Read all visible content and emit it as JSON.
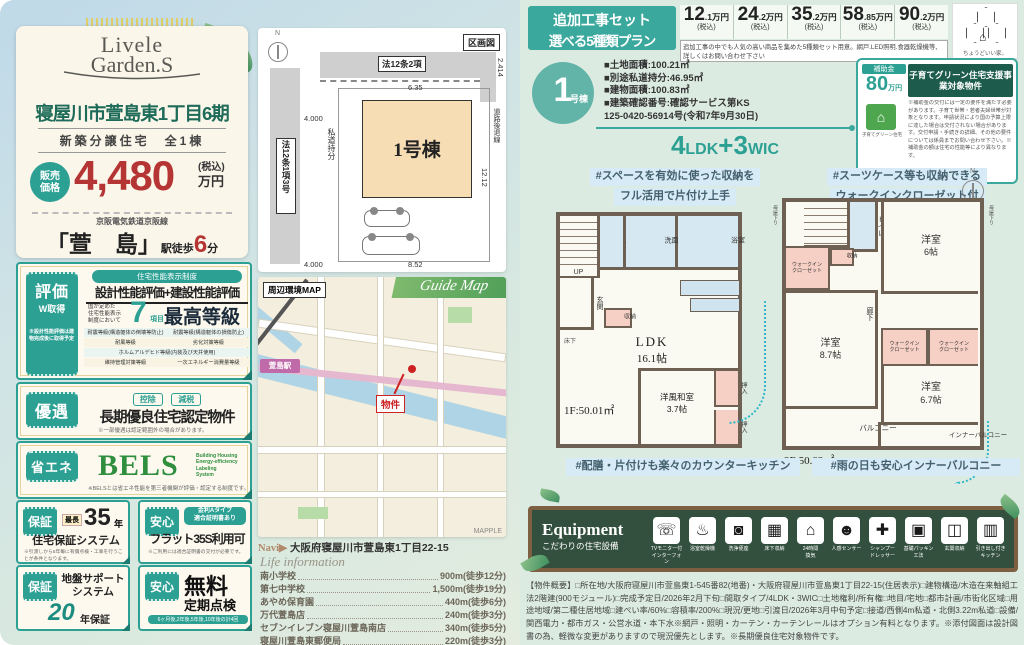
{
  "left": {
    "logo1": "Livele",
    "logo2": "Garden.S",
    "title": "寝屋川市萱島東1丁目6期",
    "subtitle": "新築分譲住宅　全1棟",
    "price": {
      "label1": "販売",
      "label2": "価格",
      "value": "4,480",
      "tax": "(税込)",
      "unit": "万円"
    },
    "rail": "京阪電気鉄道京阪線",
    "station": {
      "name": "「萱　島」",
      "pre": "駅徒歩",
      "min": "6",
      "unit": "分"
    },
    "hyouka": {
      "tab": "評価",
      "tab2": "W取得",
      "tabnote": "※設計性能評価は建物完成後に取得予定",
      "pill": "住宅性能表示制度",
      "line": "設計性能評価+建設性能評価",
      "pre1": "国が定めた",
      "pre2": "住宅性能表示",
      "pre3": "制度において",
      "num": "7",
      "numunit": "項目",
      "grade": "最高等級",
      "items": [
        "耐震等級(構造躯体の倒壊等防止)",
        "耐震等級(構造躯体の損傷防止)",
        "耐風等級",
        "劣化対策等級",
        "ホルムアルデヒド等級(内装及び天井使用)",
        "維持管理対策等級",
        "一次エネルギー消費量等級"
      ]
    },
    "yuuguu": {
      "tab": "優遇",
      "pill1": "控除",
      "pill2": "減税",
      "main": "長期優良住宅認定物件",
      "note": "※一部優遇は認定範囲外の場合があります。"
    },
    "bels": {
      "tab": "省エネ",
      "main": "BELS",
      "sub1": "Building Housing",
      "sub2": "Energy-efficiency",
      "sub3": "Labeling",
      "sub4": "System",
      "note": "※BELSとは省エネ性能を第三者機関が評価・認定する制度です。"
    },
    "hosho35": {
      "tab": "保証",
      "pre": "最長",
      "num": "35",
      "unit": "年",
      "main": "住宅保証システム",
      "note": "※引渡しから5年毎に有償点検・工事を行うことが条件となります。"
    },
    "flat35": {
      "tab": "安心",
      "pill1": "金利Aタイプ",
      "pill2": "適合証明書あり",
      "main": "フラット35S利用可",
      "note": "※ご利用には適合証明書の交付が必要です。"
    },
    "jiban": {
      "tab": "保証",
      "main1": "地盤サポート",
      "main2": "システム",
      "num": "20",
      "unit": "年保証"
    },
    "tenken": {
      "tab": "安心",
      "main1": "無料",
      "main2": "定期点検",
      "note": "6ヶ月後,2年後,5年後,10年後の計4回"
    }
  },
  "site": {
    "label": "区画図",
    "north": "N",
    "road_top": "法12条2項",
    "road_left": "法12条1項3号",
    "shidou": "私道持分",
    "building": "1号棟",
    "setback": "道路後退線",
    "dim_top": "6.35",
    "dim_right_top": "2.414",
    "dim_right": "12.12",
    "dim_bottom": "8.52",
    "dim_left": "4.000",
    "dim_bottom_left": "4.000"
  },
  "map": {
    "label": "周辺環境MAP",
    "banner": "Guide Map",
    "station": "萱島駅",
    "marker": "物件",
    "credit": "MAPPLE",
    "navi_pre": "Navi▶",
    "navi": "大阪府寝屋川市萱島東1丁目22-15"
  },
  "life": {
    "title": "Life information",
    "items": [
      {
        "name": "南小学校",
        "dist": "900m",
        "walk": "(徒歩12分)"
      },
      {
        "name": "第七中学校",
        "dist": "1,500m",
        "walk": "(徒歩19分)"
      },
      {
        "name": "あやめ保育園",
        "dist": "440m",
        "walk": "(徒歩6分)"
      },
      {
        "name": "万代萱島店",
        "dist": "240m",
        "walk": "(徒歩3分)"
      },
      {
        "name": "セブンイレブン寝屋川萱島南店",
        "dist": "340m",
        "walk": "(徒歩5分)"
      },
      {
        "name": "寝屋川萱島東郵便局",
        "dist": "220m",
        "walk": "(徒歩3分)"
      }
    ]
  },
  "right": {
    "plans": {
      "title1": "追加工事セット",
      "title2": "選べる5種類プラン",
      "note": "追加工事の中でも人気の高い商品を集めた5種類セット用意。網戸.LED照明.食器乾燥機等、詳しくはお問い合わせ下さい",
      "items": [
        {
          "main": "12",
          "sub": ".1万円",
          "tax": "(税込)"
        },
        {
          "main": "24",
          "sub": ".2万円",
          "tax": "(税込)"
        },
        {
          "main": "35",
          "sub": ".2万円",
          "tax": "(税込)"
        },
        {
          "main": "58",
          "sub": ".85万円",
          "tax": "(税込)"
        },
        {
          "main": "90",
          "sub": ".2万円",
          "tax": "(税込)"
        }
      ]
    },
    "brand": {
      "tagline": "ちょうどいい家。"
    },
    "bldg": {
      "num": "1",
      "suffix": "号棟",
      "specs": [
        "■土地面積:100.21㎡",
        "■別途私道持分:46.95㎡",
        "■建物面積:100.83㎡",
        "■建築確認番号:確認サービス第KS",
        "125-0420-56914号(令和7年9月30日)"
      ],
      "layout_n1": "4",
      "layout_t1": "LDK",
      "layout_plus": "+",
      "layout_n2": "3",
      "layout_t2": "WIC"
    },
    "subsidy": {
      "label": "補助金",
      "amount": "80",
      "unit": "万円",
      "title": "子育てグリーン住宅支援事業対象物件",
      "house_cap": "子育てグリーン住宅",
      "note": "※補助金の交付には一定の要件を満たす必要があります。子育て世帯・若者夫婦世帯が対象となります。申請状況により国の予算上限に達した場合は交付されない場合があります。交付申請・手続きの詳細、その他の要件については係員までお問い合わせ下さい。※補助金の額は住宅の性能等により異なります。"
    },
    "plan1f": {
      "cap1": "#スペースを有効に使った収納を",
      "cap2": "フル活用で片付け上手",
      "area": "1F:50.01㎡",
      "rooms": {
        "genkan": "玄関",
        "up": "UP",
        "yukashita": "床下",
        "toilet": "トイレ",
        "senmen": "洗面所",
        "bath": "浴室",
        "shuno": "収納",
        "ldk1": "LDK",
        "ldk2": "16.1帖",
        "washitsu1": "洋風和室",
        "washitsu2": "3.7帖",
        "oshiire": "押入"
      },
      "capb": "#配膳・片付けも楽々のカウンターキッチン"
    },
    "plan2f": {
      "cap1": "#スーツケース等も収納できる",
      "cap2": "ウォークインクローゼット付",
      "area": "2F:50.82㎡",
      "rooms": {
        "toilet": "トイレ",
        "y6_1": "洋室",
        "y6_2": "6帖",
        "wic1": "ウォークイン",
        "wic2": "クローゼット",
        "shuno": "収納",
        "rouka": "廊下",
        "y87_1": "洋室",
        "y87_2": "8.7帖",
        "y67_1": "洋室",
        "y67_2": "6.7帖",
        "balcony": "バルコニー",
        "inner": "インナーバルコニー",
        "moya": "母屋下り"
      },
      "capb": "#雨の日も安心インナーバルコニー"
    },
    "equipment": {
      "title": "Equipment",
      "subtitle": "こだわりの住宅設備",
      "items": [
        {
          "glyph": "☏",
          "l1": "TVモニター付",
          "l2": "インターフォン"
        },
        {
          "glyph": "♨",
          "l1": "浴室乾燥機",
          "l2": ""
        },
        {
          "glyph": "◙",
          "l1": "洗浄便座",
          "l2": ""
        },
        {
          "glyph": "▦",
          "l1": "床下収納",
          "l2": ""
        },
        {
          "glyph": "⌂",
          "l1": "24時間",
          "l2": "換気"
        },
        {
          "glyph": "☻",
          "l1": "人感センサー",
          "l2": ""
        },
        {
          "glyph": "✚",
          "l1": "シャンプー",
          "l2": "ドレッサー"
        },
        {
          "glyph": "▣",
          "l1": "基礎パッキン",
          "l2": "工法"
        },
        {
          "glyph": "◫",
          "l1": "玄関収納",
          "l2": ""
        },
        {
          "glyph": "▥",
          "l1": "引き出し付き",
          "l2": "キッチン"
        }
      ]
    },
    "overview": "【物件概要】□所在地/大阪府寝屋川市萱島東1-545番82(地番)・大阪府寝屋川市萱島東1丁目22-15(住居表示)□建物構造/木造在来軸組工法2階建(900モジュール)□完成予定日/2026年2月下旬□間取タイプ/4LDK・3WIC□土地権利/所有権□地目/宅地□都市計画/市街化区域□用途地域/第二種住居地域□建ぺい率/60%□容積率/200%□現況/更地□引渡日/2026年3月中旬予定□接道/西側4m私道・北側3.22m私道□設備/関西電力・都市ガス・公営水道・本下水※網戸・照明・カーテン・カーテンレールはオプション有料となります。※添付図面は設計図書の為、軽微な変更がありますので現況優先とします。※長期優良住宅対象物件です。"
  }
}
